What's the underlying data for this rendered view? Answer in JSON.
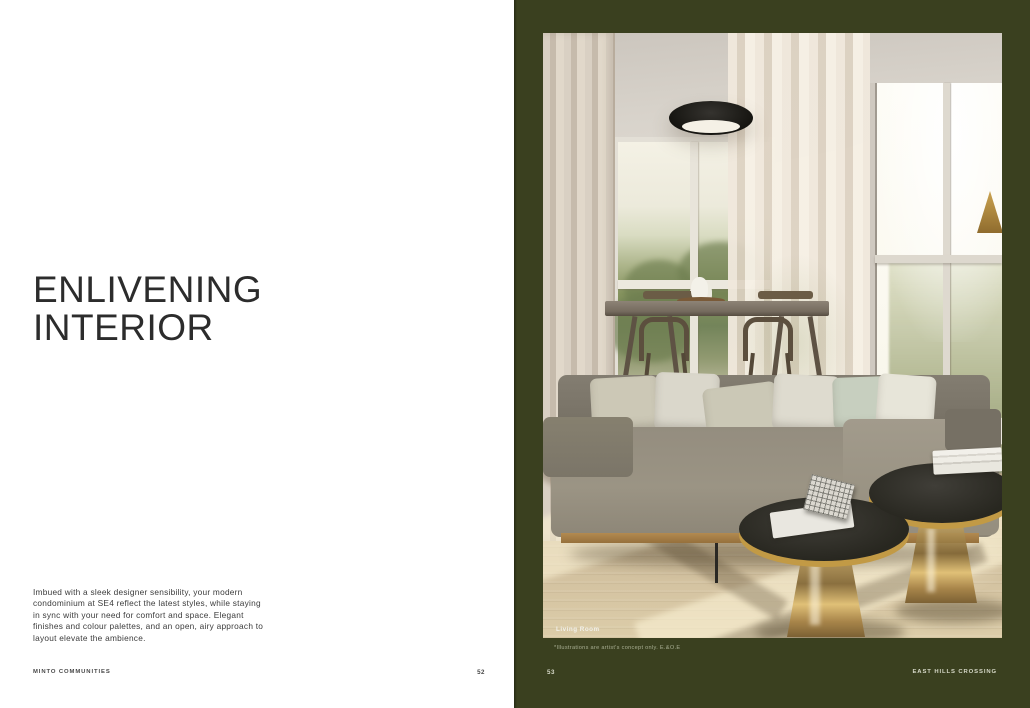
{
  "left_page": {
    "headline_lines": [
      "ENLIVENING",
      "INTERIOR"
    ],
    "body_lines": [
      "Imbued with a sleek designer sensibility, your modern",
      "condominium at SE4 reflect the latest styles, while staying",
      "in sync with your need for comfort and space. Elegant",
      "finishes and colour palettes, and an open, airy approach to",
      "layout elevate the ambience."
    ],
    "footer": {
      "brand": "MINTO COMMUNITIES",
      "page_number": "52"
    }
  },
  "right_page": {
    "photo": {
      "caption": "Living Room"
    },
    "disclaimer": "*Illustrations are artist's concept only.  E.&O.E",
    "footer": {
      "page_number": "53",
      "project": "EAST HILLS CROSSING"
    },
    "colors": {
      "page_background": "#3a401f",
      "accent_gold": "#c29a45",
      "headline_text": "#2c2c2c"
    }
  }
}
